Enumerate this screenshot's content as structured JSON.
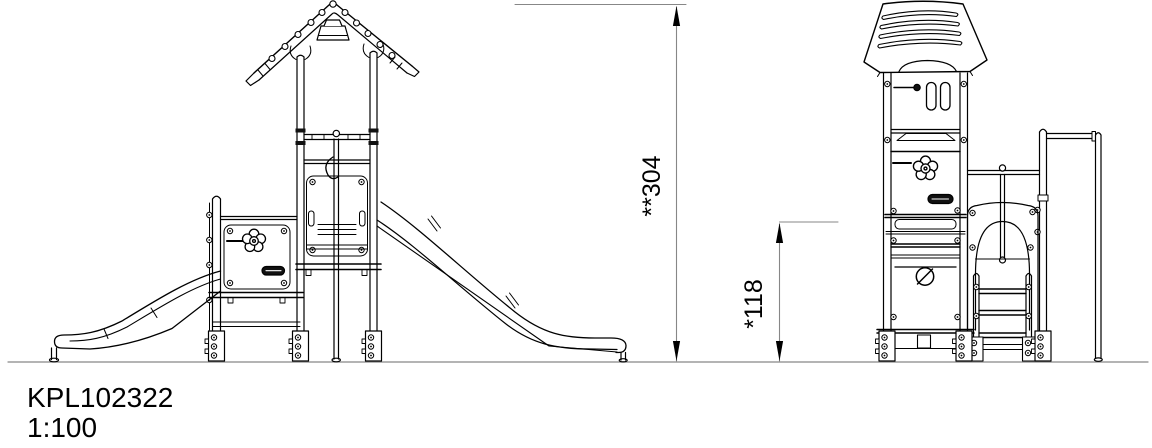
{
  "drawing": {
    "title_block": {
      "product_code": "KPL102322",
      "scale": "1:100"
    },
    "dimensions": {
      "total_height": {
        "label": "**304",
        "value": 304
      },
      "platform_height": {
        "label": "*118",
        "value": 118
      }
    },
    "colors": {
      "line": "#000000",
      "dimension_line": "#878787",
      "background": "#ffffff"
    }
  }
}
